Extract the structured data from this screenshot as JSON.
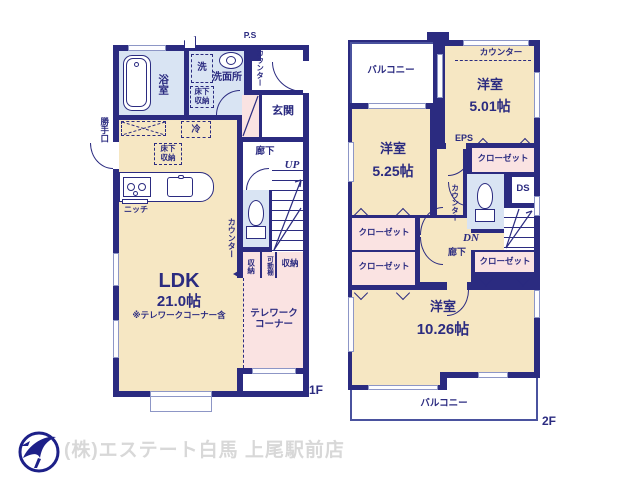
{
  "colors": {
    "wall": "#2b2b80",
    "room_cream": "#f6e7c3",
    "wet_blue": "#d9e4f3",
    "closet_pink": "#fae3e2",
    "logo_navy": "#1d2088",
    "footer_gray": "#d8d8d8"
  },
  "floor1": {
    "floor_label": "1F",
    "ps": "P.S",
    "counter_entry": "カウンター",
    "bathroom": "浴室",
    "washer": "洗",
    "washroom": "洗面所",
    "underfloor_storage_washroom": "床下収納",
    "entrance": "玄関",
    "back_door": "勝手口",
    "fridge": "冷",
    "underfloor_storage_kitchen": "床下収納",
    "niche": "ニッチ",
    "hallway": "廊下",
    "stairs_up": "UP",
    "counter_kitchen": "カウンター",
    "storage_a": "収納",
    "movable_shelf": "可動棚",
    "storage_b": "収納",
    "ldk_name": "LDK",
    "ldk_size": "21.0帖",
    "ldk_note": "※テレワークコーナー含",
    "telework": "テレワークコーナー"
  },
  "floor2": {
    "floor_label": "2F",
    "balcony_top": "バルコニー",
    "counter_501": "カウンター",
    "room_501_name": "洋室",
    "room_501_size": "5.01帖",
    "room_525_name": "洋室",
    "room_525_size": "5.25帖",
    "eps": "EPS",
    "closet_top_right": "クローゼット",
    "counter_wc": "カウンター",
    "ds": "DS",
    "stairs_down": "DN",
    "hallway": "廊下",
    "closet_left_upper": "クローゼット",
    "closet_left_lower": "クローゼット",
    "closet_bottom_right": "クローゼット",
    "room_1026_name": "洋室",
    "room_1026_size": "10.26帖",
    "balcony_bottom": "バルコニー"
  },
  "footer": {
    "company": "(株)エステート白馬 上尾駅前店"
  }
}
